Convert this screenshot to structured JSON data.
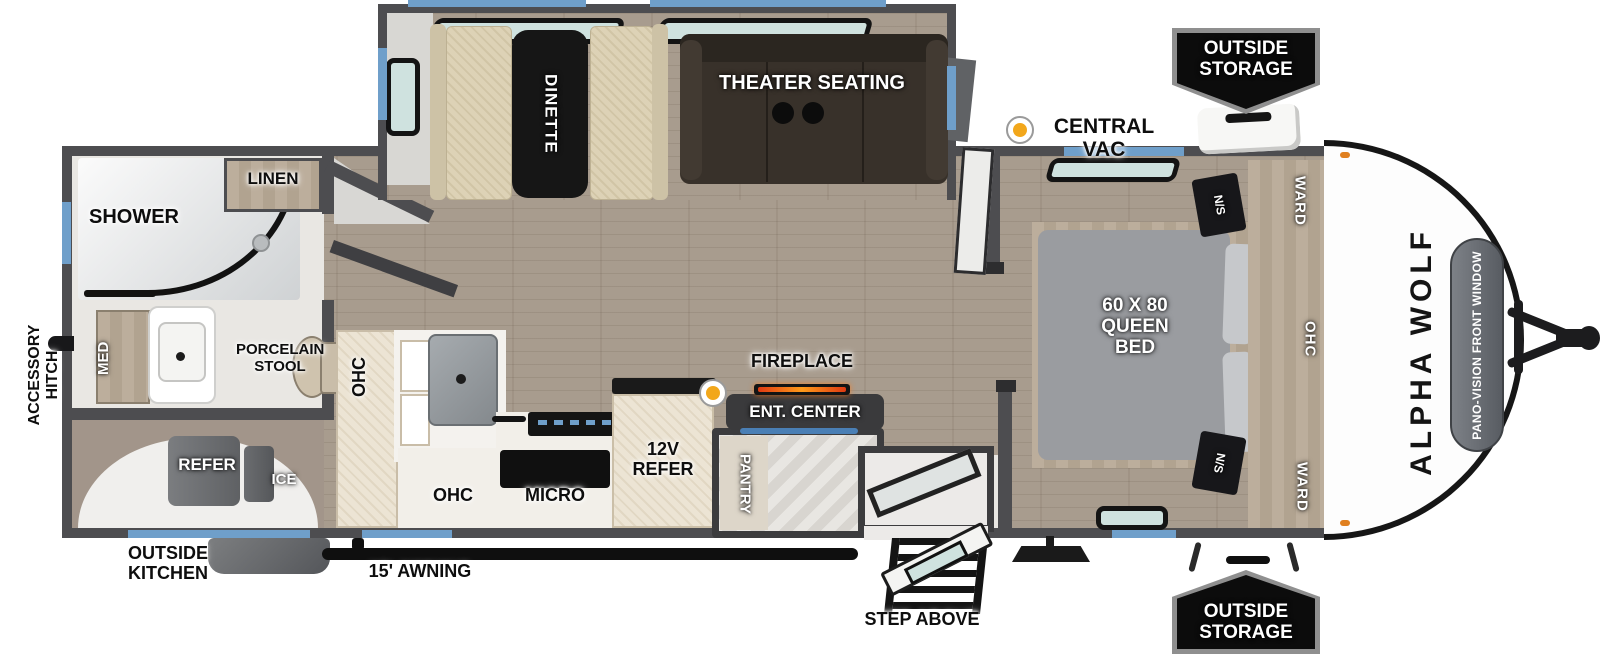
{
  "labels": {
    "dinette": "DINETTE",
    "theater": "THEATER SEATING",
    "central_vac": "CENTRAL VAC",
    "storage_front": "OUTSIDE\nSTORAGE",
    "storage_rear": "OUTSIDE\nSTORAGE",
    "linen": "LINEN",
    "shower": "SHOWER",
    "med": "MED",
    "stool": "PORCELAIN\nSTOOL",
    "accessory_hitch": "ACCESSORY\nHITCH",
    "refer": "REFER",
    "ice": "ICE",
    "outside_kitchen": "OUTSIDE\nKITCHEN",
    "awning": "15' AWNING",
    "ohc_kitchen_side": "OHC",
    "ohc_kitchen": "OHC",
    "micro": "MICRO",
    "refer_12v": "12V\nREFER",
    "pantry": "PANTRY",
    "fireplace": "FIREPLACE",
    "ent_center": "ENT. CENTER",
    "step_above": "STEP ABOVE",
    "queen_bed": "60 X 80\nQUEEN\nBED",
    "ns_top": "N/S",
    "ns_bottom": "N/S",
    "ward_top": "WARD",
    "ward_bottom": "WARD",
    "ohc_bedroom": "OHC"
  },
  "brand": {
    "name": "ALPHA WOLF",
    "front_window": "PANO-VISION FRONT WINDOW"
  },
  "colors": {
    "wall": "#4d4d50",
    "window_accent": "#6f9fca",
    "vac_dot": "#f2a71b",
    "floor_wood": "#a89c8e",
    "badge_bg": "#0c0c0c",
    "fireplace_glow": "#ff7a1a"
  }
}
